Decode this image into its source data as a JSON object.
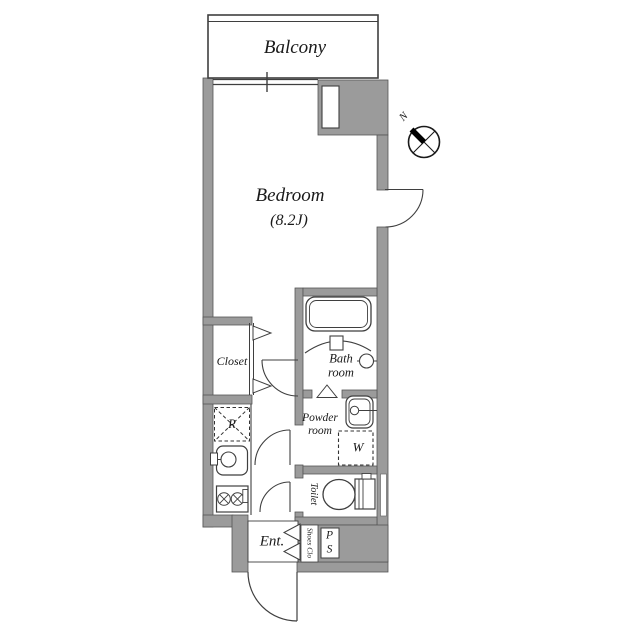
{
  "plan": {
    "rooms": {
      "balcony": "Balcony",
      "bedroom_name": "Bedroom",
      "bedroom_size": "(8.2J)",
      "closet": "Closet",
      "bathroom_line1": "Bath",
      "bathroom_line2": "room",
      "powder_line1": "Powder",
      "powder_line2": "room",
      "toilet": "Toilet",
      "entrance": "Ent.",
      "shoes_closet": "Shoes Clo",
      "pipe_space_line1": "P",
      "pipe_space_line2": "S"
    },
    "fixtures": {
      "washer": "W",
      "refrigerator": "R"
    },
    "compass_north": "N",
    "colors": {
      "wall_fill": "#9b9b9b",
      "wall_outline": "#565656",
      "line": "#3f3f3f",
      "text": "#1a1a1a",
      "background": "#ffffff"
    }
  }
}
